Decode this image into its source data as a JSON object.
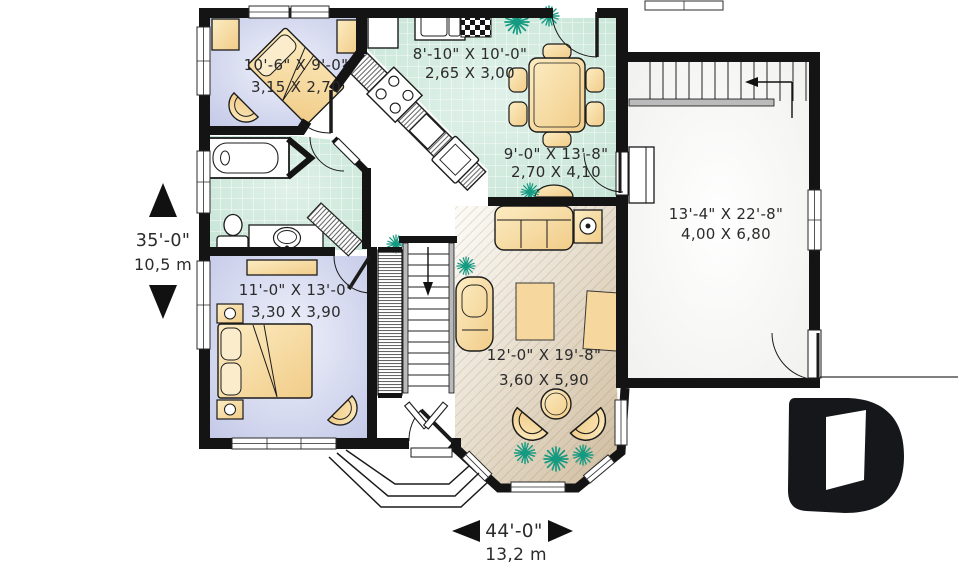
{
  "floor_plan": {
    "type": "house-floor-plan",
    "rooms": [
      {
        "name": "bedroom-upper",
        "imperial": "10'-6\" X 9'-0\"",
        "metric": "3,15 X 2,70"
      },
      {
        "name": "kitchen",
        "imperial": "8'-10\" X 10'-0\"",
        "metric": "2,65 X 3,00"
      },
      {
        "name": "dining",
        "imperial": "9'-0\" X 13'-8\"",
        "metric": "2,70 X 4,10"
      },
      {
        "name": "garage",
        "imperial": "13'-4\" X 22'-8\"",
        "metric": "4,00 X 6,80"
      },
      {
        "name": "bedroom-lower",
        "imperial": "11'-0\" X 13'-0\"",
        "metric": "3,30 X 3,90"
      },
      {
        "name": "living",
        "imperial": "12'-0\" X 19'-8\"",
        "metric": "3,60 X 5,90"
      }
    ],
    "overall_depth": {
      "imperial": "35'-0\"",
      "metric": "10,5 m"
    },
    "overall_width": {
      "imperial": "44'-0\"",
      "metric": "13,2 m"
    },
    "logo_letter": "D",
    "colors": {
      "wall": "#141414",
      "bedroom_floor": "#c5cae7",
      "tile_floor": "#cde8da",
      "wood_floor": "#d7c5aa",
      "furniture": "#f5d69c",
      "plant": "#149a81",
      "text": "#2b2b2b"
    }
  }
}
